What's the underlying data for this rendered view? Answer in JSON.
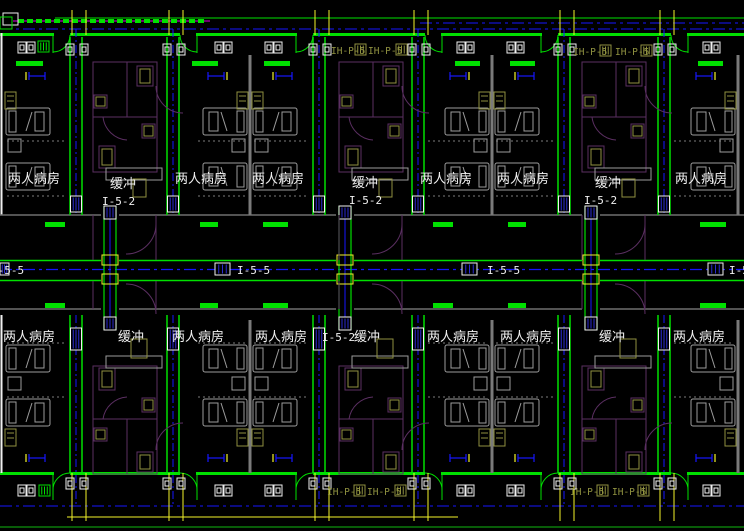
{
  "drawing": {
    "background": "#000000",
    "colors": {
      "wall_green": "#00e000",
      "dark_green": "#0a7a0a",
      "blue": "#1616ff",
      "yellow": "#f5f52a",
      "white": "#f0f0f0",
      "furniture_gray": "#9c9c9c",
      "dotted_gray": "#7d7d7d",
      "wall_gray": "#6f6f6f",
      "purple": "#5b2f62",
      "magenta": "#e000e0",
      "olive": "#8f9140",
      "hatch_blue": "#2a2ad0"
    },
    "labels": [
      {
        "text": "两人病房",
        "x": 8,
        "y": 183,
        "style": "cjk"
      },
      {
        "text": "两人病房",
        "x": 175,
        "y": 183,
        "style": "cjk"
      },
      {
        "text": "两人病房",
        "x": 252,
        "y": 183,
        "style": "cjk"
      },
      {
        "text": "两人病房",
        "x": 420,
        "y": 183,
        "style": "cjk"
      },
      {
        "text": "两人病房",
        "x": 497,
        "y": 183,
        "style": "cjk"
      },
      {
        "text": "两人病房",
        "x": 675,
        "y": 183,
        "style": "cjk"
      },
      {
        "text": "缓冲",
        "x": 110,
        "y": 188,
        "style": "cjk"
      },
      {
        "text": "缓冲",
        "x": 352,
        "y": 187,
        "style": "cjk"
      },
      {
        "text": "缓冲",
        "x": 595,
        "y": 187,
        "style": "cjk"
      },
      {
        "text": "I-5-2",
        "x": 102,
        "y": 205,
        "style": "code"
      },
      {
        "text": "I-5-2",
        "x": 349,
        "y": 204,
        "style": "code"
      },
      {
        "text": "I-5-2",
        "x": 584,
        "y": 204,
        "style": "code"
      },
      {
        "text": "I-5-5",
        "x": -9,
        "y": 274,
        "style": "code"
      },
      {
        "text": "I-5-5",
        "x": 237,
        "y": 274,
        "style": "code"
      },
      {
        "text": "I-5-5",
        "x": 487,
        "y": 274,
        "style": "code"
      },
      {
        "text": "I-5-5",
        "x": 729,
        "y": 274,
        "style": "code"
      },
      {
        "text": "两人病房",
        "x": 3,
        "y": 341,
        "style": "cjk"
      },
      {
        "text": "两人病房",
        "x": 172,
        "y": 341,
        "style": "cjk"
      },
      {
        "text": "两人病房",
        "x": 255,
        "y": 341,
        "style": "cjk"
      },
      {
        "text": "两人病房",
        "x": 427,
        "y": 341,
        "style": "cjk"
      },
      {
        "text": "两人病房",
        "x": 500,
        "y": 341,
        "style": "cjk"
      },
      {
        "text": "两人病房",
        "x": 673,
        "y": 341,
        "style": "cjk"
      },
      {
        "text": "缓冲",
        "x": 118,
        "y": 341,
        "style": "cjk"
      },
      {
        "text": "I-5-2",
        "x": 322,
        "y": 341,
        "style": "code"
      },
      {
        "text": "缓冲",
        "x": 354,
        "y": 341,
        "style": "cjk"
      },
      {
        "text": "缓冲",
        "x": 599,
        "y": 341,
        "style": "cjk"
      },
      {
        "text": "IH-P-5",
        "x": 331,
        "y": 54,
        "style": "olive"
      },
      {
        "text": "IH-P-5",
        "x": 368,
        "y": 54,
        "style": "olive"
      },
      {
        "text": "IH-P-5",
        "x": 573,
        "y": 55,
        "style": "olive"
      },
      {
        "text": "IH-P-5",
        "x": 615,
        "y": 55,
        "style": "olive"
      },
      {
        "text": "IH-P-5",
        "x": 327,
        "y": 495,
        "style": "olive"
      },
      {
        "text": "IH-P-5",
        "x": 367,
        "y": 495,
        "style": "olive"
      },
      {
        "text": "IH-P-5",
        "x": 570,
        "y": 495,
        "style": "olive"
      },
      {
        "text": "IH-P-5",
        "x": 612,
        "y": 495,
        "style": "olive"
      }
    ]
  }
}
